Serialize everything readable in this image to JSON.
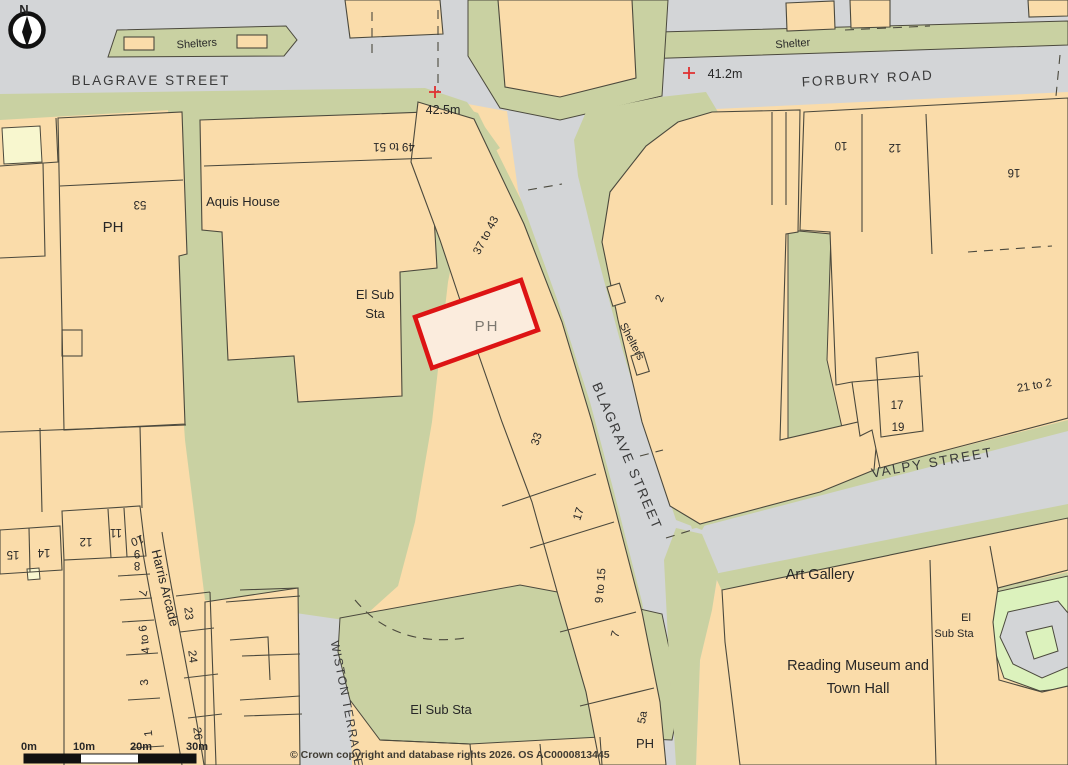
{
  "map": {
    "compass": {
      "north_label": "N"
    },
    "colors": {
      "road": "#d3d5d7",
      "verge_green": "#c9d1a2",
      "park_lightgreen": "#dcf2bd",
      "building_peach": "#fadcaa",
      "pale_yellow": "#f8f7cf",
      "outline": "#4b493d",
      "plot_border_red": "#dd1414",
      "plot_fill": "#fbecdd",
      "spot_height_red": "#e03030"
    },
    "streets": {
      "blagrave_top": "BLAGRAVE STREET",
      "blagrave_diag": "BLAGRAVE STREET",
      "forbury": "FORBURY ROAD",
      "valpy": "VALPY STREET",
      "wiston": "WISTON TERRACE",
      "harris": "Harris Arcade"
    },
    "spot_heights": {
      "h1": "42.5m",
      "h2": "41.2m"
    },
    "labels": {
      "shelters_top": "Shelters",
      "shelter_tr": "Shelter",
      "shelters_diag": "Shelters",
      "aquis": "Aquis House",
      "el_sub_center_1": "El Sub",
      "el_sub_center_2": "Sta",
      "el_sub_bottom": "El Sub Sta",
      "el_sub_right_1": "El",
      "el_sub_right_2": "Sub Sta",
      "art_gallery": "Art Gallery",
      "museum_1": "Reading Museum and",
      "museum_2": "Town Hall",
      "ph_left": "PH",
      "ph_plot": "PH",
      "ph_bottom": "PH"
    },
    "numbers": {
      "n53": "53",
      "n49to51": "49 to 51",
      "n37to43": "37 to 43",
      "n2": "2",
      "n10": "10",
      "n12": "12",
      "n16": "16",
      "n17a": "17",
      "n19": "19",
      "n21to2": "21 to 2",
      "n33": "33",
      "n17b": "17",
      "n9to15": "9 to 15",
      "n7a": "7",
      "n5a": "5a",
      "n12b": "12",
      "n11": "11",
      "n10b": "10",
      "n15": "15",
      "n14": "14",
      "n8": "8",
      "n9": "9",
      "n7b": "7",
      "n4to6": "4 to 6",
      "n3": "3",
      "n1": "1",
      "n23": "23",
      "n24": "24",
      "n26": "26"
    },
    "scale_bar": {
      "t0": "0m",
      "t10": "10m",
      "t20": "20m",
      "t30": "30m"
    },
    "copyright": "© Crown copyright and database rights 2026. OS AC0000813445"
  }
}
